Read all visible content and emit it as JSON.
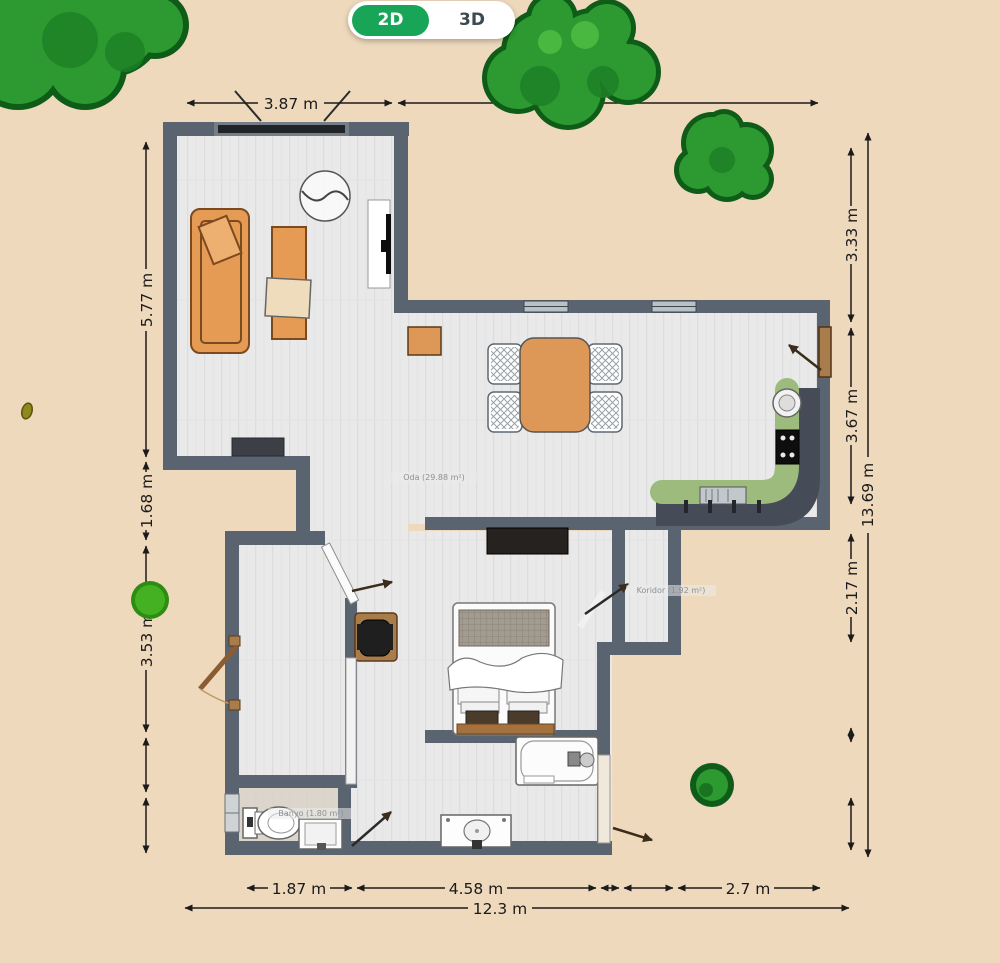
{
  "toggle": {
    "option_2d": "2D",
    "option_3d": "3D",
    "active": "2D"
  },
  "dimensions": {
    "top_living_width": "3.87 m",
    "left_living_height": "5.77 m",
    "left_step": "1.68 m",
    "left_hall": "3.53 m",
    "right_top": "3.33 m",
    "right_kitchen": "3.67 m",
    "right_room": "2.17 m",
    "right_total": "13.69 m",
    "bottom_wc": "1.87 m",
    "bottom_middle": "4.58 m",
    "bottom_right": "2.7 m",
    "bottom_total": "12.3 m"
  },
  "room_labels": {
    "living": "Oda (29.88 m²)",
    "corridor": "Koridor (1.92 m²)",
    "bathroom": "Banyo (1.80 m²)"
  },
  "colors": {
    "accent_green": "#18a558",
    "background": "#eed9bc",
    "wall": "#5a6370",
    "floor": "#e9e9e9",
    "furniture_orange": "#e59b54",
    "counter_green": "#9dbb7d",
    "tree_green": "#2c9a31",
    "dimension_line": "#1b1b1b"
  }
}
